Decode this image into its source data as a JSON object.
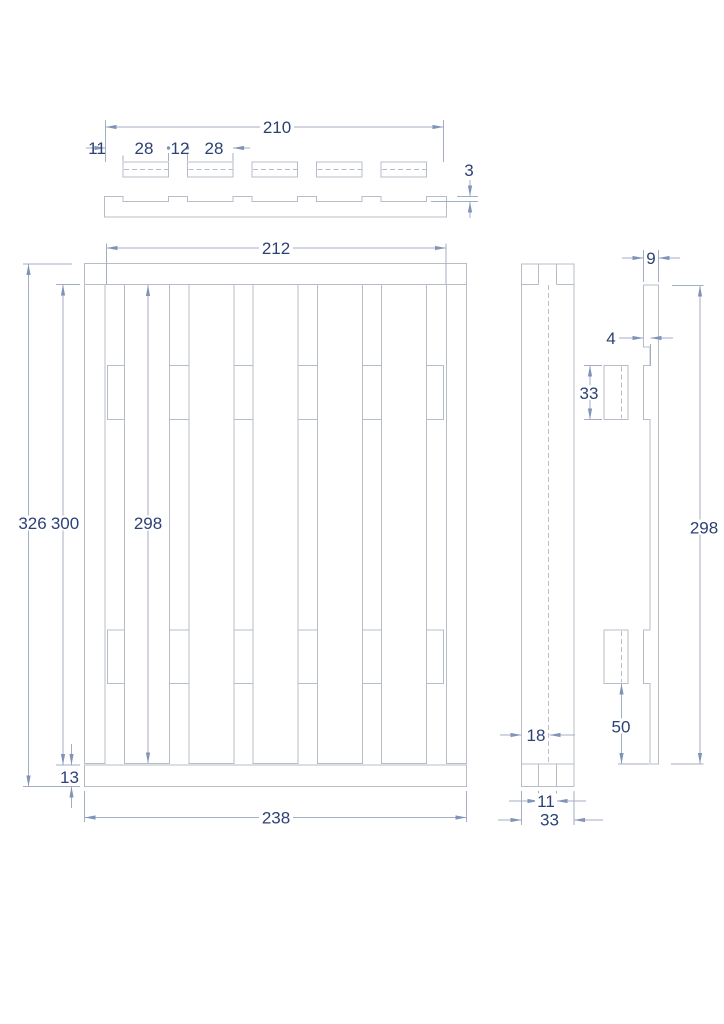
{
  "drawing": {
    "type": "technical-drawing",
    "subject": "slatted pallet / crate panel, three orthographic views"
  },
  "colors": {
    "background": "#ffffff",
    "object_line": "#b7bdc7",
    "dimension_line": "#a3aec5",
    "arrow": "#8093b8",
    "text": "#2c4175"
  },
  "dimensions": {
    "top_view": {
      "overall_width": "210",
      "edge_margin": "11",
      "slot_width_a": "28",
      "slot_gap": "12",
      "slot_width_b": "28",
      "recess_depth": "3"
    },
    "front_view": {
      "cap_width": "212",
      "overall_height": "326",
      "inner_height": "300",
      "slat_length": "298",
      "rail_thickness": "13",
      "overall_width": "238"
    },
    "side_view": {
      "slat_depth": "18",
      "slot_width": "11",
      "overall_depth": "33"
    },
    "detail_view": {
      "plank_thickness": "9",
      "notch_depth": "4",
      "block_height": "33",
      "block_offset": "50",
      "plank_length": "298"
    }
  }
}
